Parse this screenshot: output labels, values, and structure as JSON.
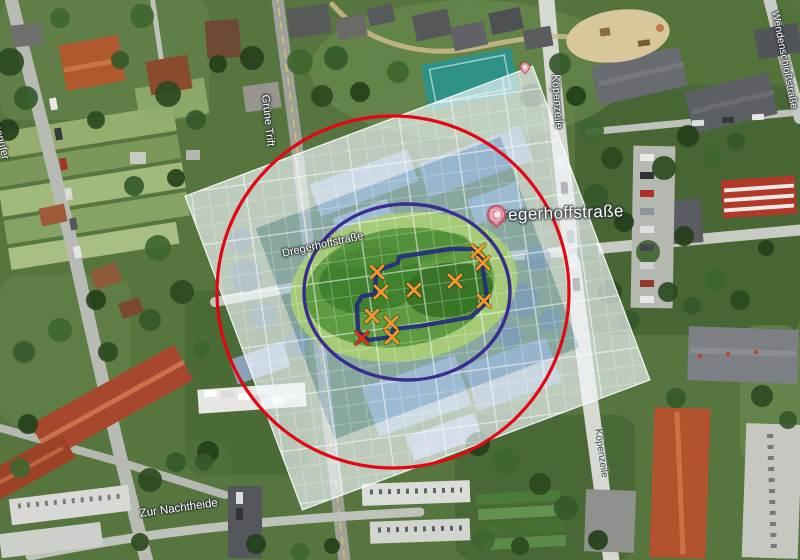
{
  "street_labels": {
    "dregerhoffstrasse_major": "Dregerhoffstraße",
    "dregerhoffstrasse_minor": "Dregerhoffstraße",
    "gruene_trift": "Grüne Trift",
    "koepenzeile_north": "Köpenzeile",
    "koepenzeile_south": "Köpenzeile",
    "zur_nachtheide": "Zur Nachtheide",
    "moellhausenufer": "Möllhausenufer",
    "wendenschlossstrasse": "Wendenschloßstraße"
  },
  "overlay": {
    "outer_circle": {
      "cx": 393,
      "cy": 292,
      "r": 176,
      "color": "#e30613",
      "width": 3.2
    },
    "inner_ellipse": {
      "cx": 407,
      "cy": 292,
      "rx": 103,
      "ry": 88,
      "color": "#3a2d8e",
      "width": 3.4
    },
    "site_polygon": {
      "points": "376,271 398,263 399,257 450,249 477,249 482,262 486,291 487,302 471,317 420,326 393,329 392,337 368,340 358,331 357,305 362,296 375,294",
      "color": "#252c7d",
      "width": 4.3
    },
    "grid_color": "#ffffff"
  },
  "markers": {
    "x_glyph": "✕",
    "orange_color": "#f59a2a",
    "red_color": "#e0301a",
    "orange_positions": [
      [
        377,
        272
      ],
      [
        478,
        251
      ],
      [
        483,
        263
      ],
      [
        484,
        301
      ],
      [
        455,
        281
      ],
      [
        414,
        290
      ],
      [
        381,
        292
      ],
      [
        372,
        316
      ],
      [
        391,
        323
      ],
      [
        392,
        337
      ]
    ],
    "red_positions": [
      [
        362,
        338
      ]
    ]
  },
  "pins": {
    "dregerhoff_pin": {
      "x": 495,
      "y": 226
    },
    "small_poi_pin": {
      "x": 524,
      "y": 74
    }
  }
}
